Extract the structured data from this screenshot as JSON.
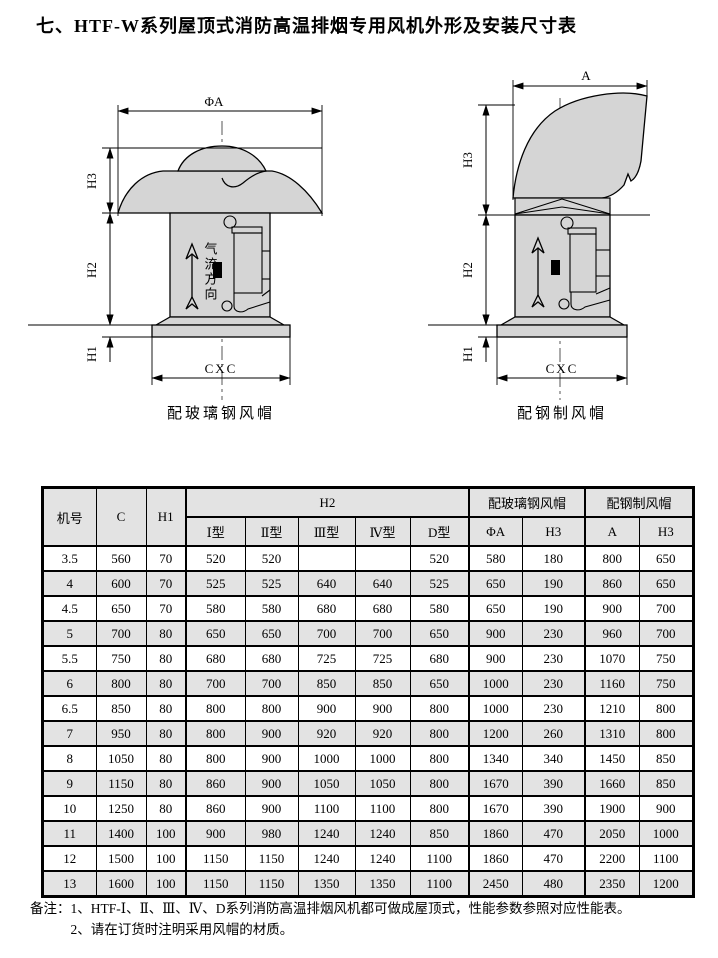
{
  "page": {
    "title": "七、HTF-W系列屋顶式消防高温排烟专用风机外形及安装尺寸表"
  },
  "colors": {
    "line": "#000000",
    "diagram_fill": "#d5d5d5",
    "table_shade": "#e3e3e3"
  },
  "diagrams": {
    "left": {
      "caption": "配玻璃钢风帽",
      "dim_top": "ΦA",
      "dim_h3": "H3",
      "dim_h2": "H2",
      "dim_h1": "H1",
      "dim_bottom": "CXC",
      "airflow_label": "气流方向"
    },
    "right": {
      "caption": "配钢制风帽",
      "dim_top": "A",
      "dim_h3": "H3",
      "dim_h2": "H2",
      "dim_h1": "H1",
      "dim_bottom": "CXC"
    }
  },
  "table": {
    "header": {
      "col_fan": "机号",
      "col_c": "C",
      "col_h1": "H1",
      "group_h2": "H2",
      "group_frp": "配玻璃钢风帽",
      "group_steel": "配钢制风帽",
      "sub": [
        "Ⅰ型",
        "Ⅱ型",
        "Ⅲ型",
        "Ⅳ型",
        "D型",
        "ΦA",
        "H3",
        "A",
        "H3"
      ]
    },
    "rows": [
      [
        "3.5",
        "560",
        "70",
        "520",
        "520",
        "",
        "",
        "520",
        "580",
        "180",
        "800",
        "650"
      ],
      [
        "4",
        "600",
        "70",
        "525",
        "525",
        "640",
        "640",
        "525",
        "650",
        "190",
        "860",
        "650"
      ],
      [
        "4.5",
        "650",
        "70",
        "580",
        "580",
        "680",
        "680",
        "580",
        "650",
        "190",
        "900",
        "700"
      ],
      [
        "5",
        "700",
        "80",
        "650",
        "650",
        "700",
        "700",
        "650",
        "900",
        "230",
        "960",
        "700"
      ],
      [
        "5.5",
        "750",
        "80",
        "680",
        "680",
        "725",
        "725",
        "680",
        "900",
        "230",
        "1070",
        "750"
      ],
      [
        "6",
        "800",
        "80",
        "700",
        "700",
        "850",
        "850",
        "650",
        "1000",
        "230",
        "1160",
        "750"
      ],
      [
        "6.5",
        "850",
        "80",
        "800",
        "800",
        "900",
        "900",
        "800",
        "1000",
        "230",
        "1210",
        "800"
      ],
      [
        "7",
        "950",
        "80",
        "800",
        "900",
        "920",
        "920",
        "800",
        "1200",
        "260",
        "1310",
        "800"
      ],
      [
        "8",
        "1050",
        "80",
        "800",
        "900",
        "1000",
        "1000",
        "800",
        "1340",
        "340",
        "1450",
        "850"
      ],
      [
        "9",
        "1150",
        "80",
        "860",
        "900",
        "1050",
        "1050",
        "800",
        "1670",
        "390",
        "1660",
        "850"
      ],
      [
        "10",
        "1250",
        "80",
        "860",
        "900",
        "1100",
        "1100",
        "800",
        "1670",
        "390",
        "1900",
        "900"
      ],
      [
        "11",
        "1400",
        "100",
        "900",
        "980",
        "1240",
        "1240",
        "850",
        "1860",
        "470",
        "2050",
        "1000"
      ],
      [
        "12",
        "1500",
        "100",
        "1150",
        "1150",
        "1240",
        "1240",
        "1100",
        "1860",
        "470",
        "2200",
        "1100"
      ],
      [
        "13",
        "1600",
        "100",
        "1150",
        "1150",
        "1350",
        "1350",
        "1100",
        "2450",
        "480",
        "2350",
        "1200"
      ]
    ]
  },
  "notes": {
    "prefix": "备注：",
    "line1": "1、HTF-Ⅰ、Ⅱ、Ⅲ、Ⅳ、D系列消防高温排烟风机都可做成屋顶式，性能参数参照对应性能表。",
    "line2": "2、请在订货时注明采用风帽的材质。"
  }
}
